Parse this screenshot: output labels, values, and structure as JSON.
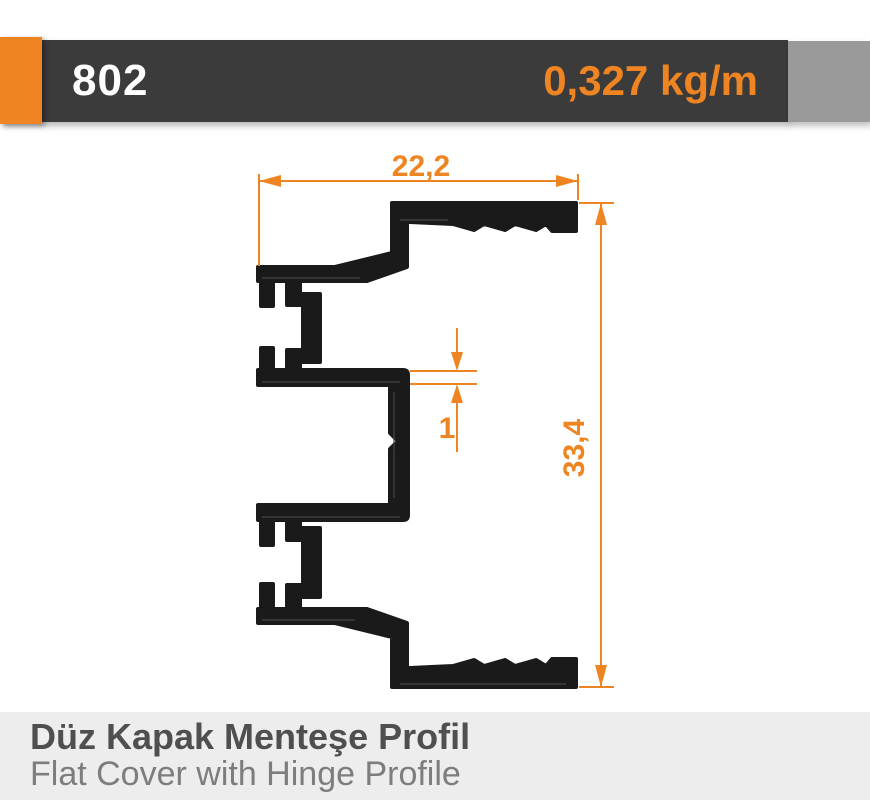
{
  "header": {
    "product_code": "802",
    "unit_weight": "0,327 kg/m"
  },
  "drawing": {
    "width_dimension": "22,2",
    "height_dimension": "33,4",
    "wall_thickness_dimension": "1"
  },
  "footer": {
    "title_tr": "Düz Kapak Menteşe Profil",
    "subtitle_en": "Flat Cover with Hinge Profile"
  },
  "colors": {
    "accent_orange": "#ef8522",
    "header_bar": "#3b3b3b",
    "header_gray_block": "#9a9a9a",
    "footer_background": "#ededed",
    "profile_black": "#1a1a1a"
  }
}
